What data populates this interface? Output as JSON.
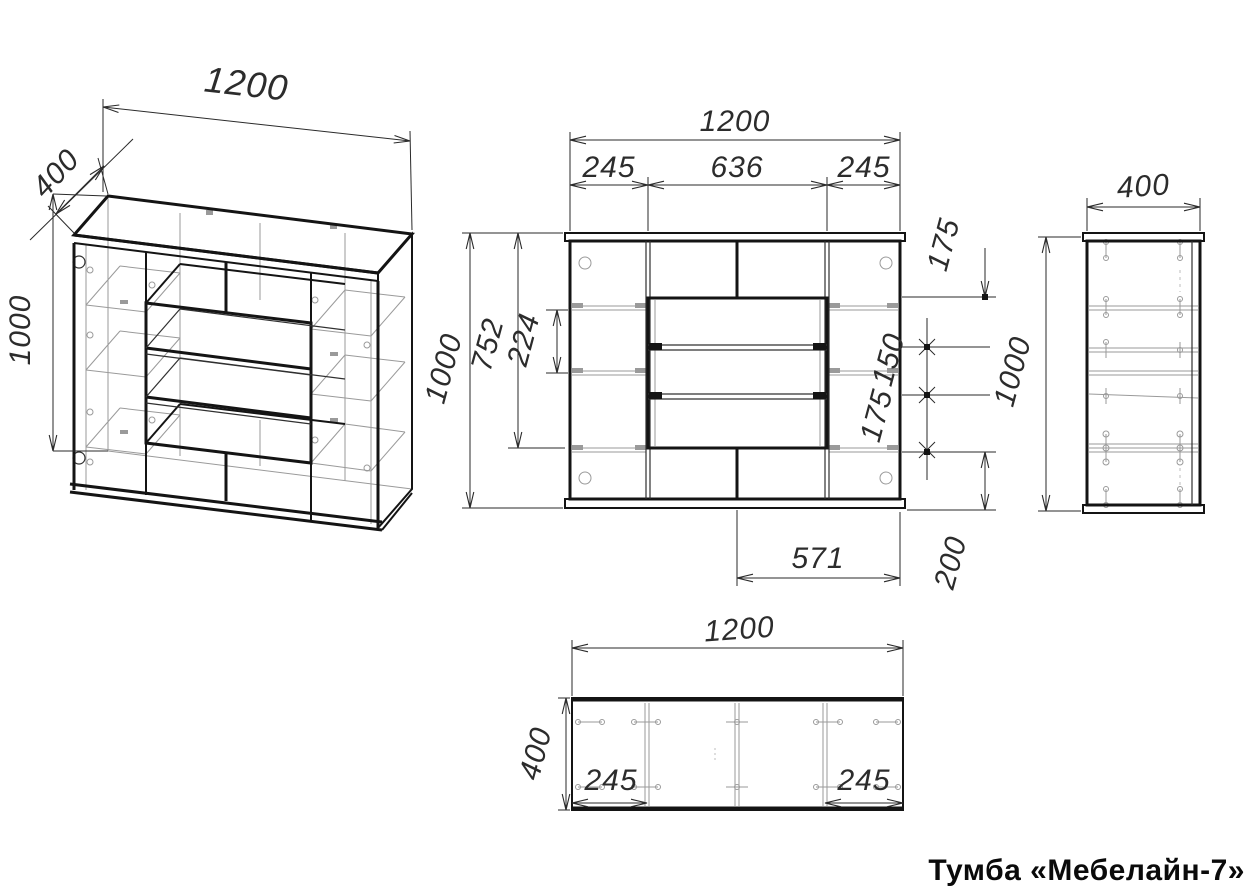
{
  "title": "Тумба «Мебелайн-7»",
  "iso": {
    "width": "1200",
    "depth": "400",
    "height": "1000"
  },
  "front": {
    "width": "1200",
    "col_left": "245",
    "col_mid": "636",
    "col_right": "245",
    "height": "1000",
    "inner_height": "752",
    "shelf_gap": "224",
    "top_offset": "175",
    "drawer_gap_1": "150",
    "drawer_gap_2": "175",
    "bottom_offset": "200",
    "base_width": "571"
  },
  "side": {
    "depth": "400",
    "height": "1000"
  },
  "plan": {
    "width": "1200",
    "depth": "400",
    "inset_left": "245",
    "inset_right": "245"
  }
}
